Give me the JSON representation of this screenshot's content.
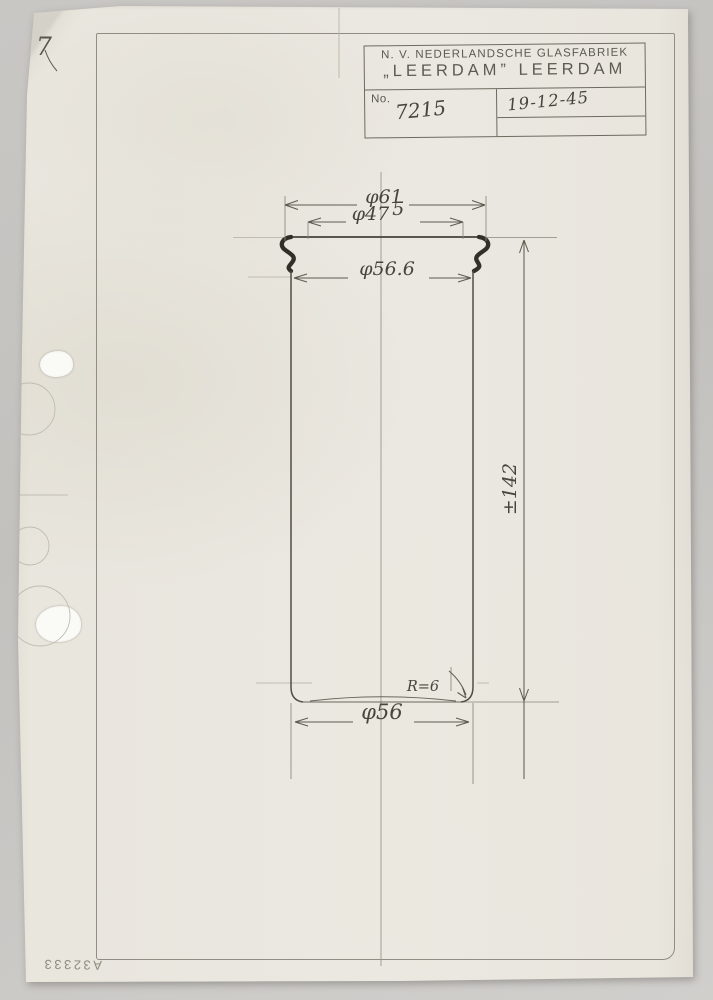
{
  "page": {
    "corner_mark": "7",
    "reverse_stamp": "A32333"
  },
  "title_block": {
    "company_line1": "N. V. NEDERLANDSCHE GLASFABRIEK",
    "company_line2": "„LEERDAM” LEERDAM",
    "no_label": "No.",
    "drawing_number": "7215",
    "date": "19-12-45"
  },
  "drawing": {
    "dim_outer_diameter": "φ61",
    "dim_mouth_diameter": "φ47",
    "dim_mouth_diameter_sup": "5",
    "dim_shoulder_diameter": "φ56.6",
    "dim_base_diameter": "φ56",
    "dim_height": "±142",
    "dim_base_radius": "R=6"
  },
  "colors": {
    "paper": "#eae7e0",
    "background": "#c6c4c1",
    "pencil": "#55524a",
    "stamp_ink": "#6e6a60"
  }
}
